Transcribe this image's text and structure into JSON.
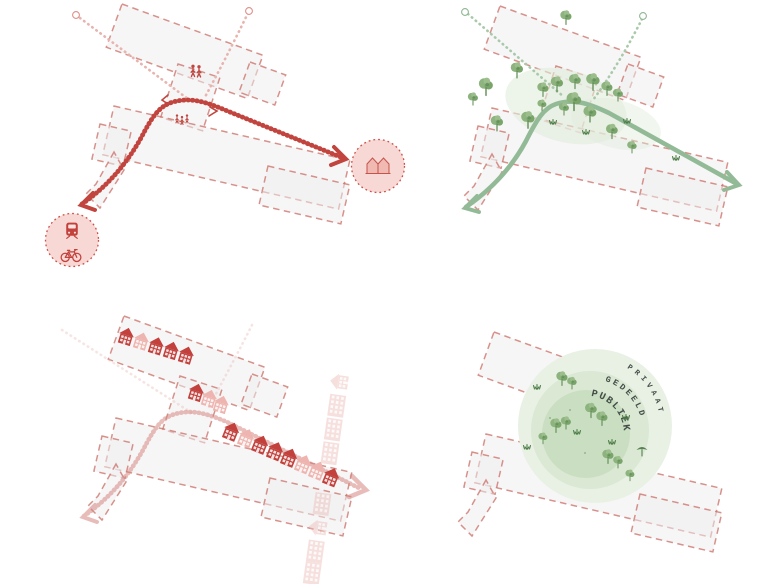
{
  "canvas": {
    "width": 762,
    "height": 584,
    "background": "#ffffff"
  },
  "zones_panel": {
    "labels": {
      "outer": "PRIVAAT",
      "middle": "GEDEELD",
      "inner": "PUBLIEK"
    }
  },
  "icons": [
    "train-icon",
    "bicycle-icon",
    "pedestrian-icon",
    "paired-houses-icon",
    "house-icon",
    "apartment-block-icon",
    "tree-icon",
    "shrub-icon",
    "route-arrowhead-icon",
    "destination-dot-icon"
  ],
  "colors": {
    "site_outline": "#cb6d65",
    "site_fill": "#ededef",
    "route_red": "#c1453e",
    "route_red_faded": "#d58781",
    "branch_pink": "#e8b4af",
    "badge_fill": "#f7d8d4",
    "badge_border": "#cb4f47",
    "house_dark": "#c2413c",
    "house_light": "#eeb5b0",
    "house_faded": "#edbcb7",
    "route_green": "#93ba96",
    "branch_green": "#a9c9aa",
    "tree_green": "#79a56b",
    "tree_dark": "#5d8a52",
    "wash_green": "#e1ecdb",
    "zone_outer": "#e9f1e5",
    "zone_middle": "#dae8d4",
    "zone_inner": "#cadfc2",
    "zone_label_text": "#454e49"
  }
}
